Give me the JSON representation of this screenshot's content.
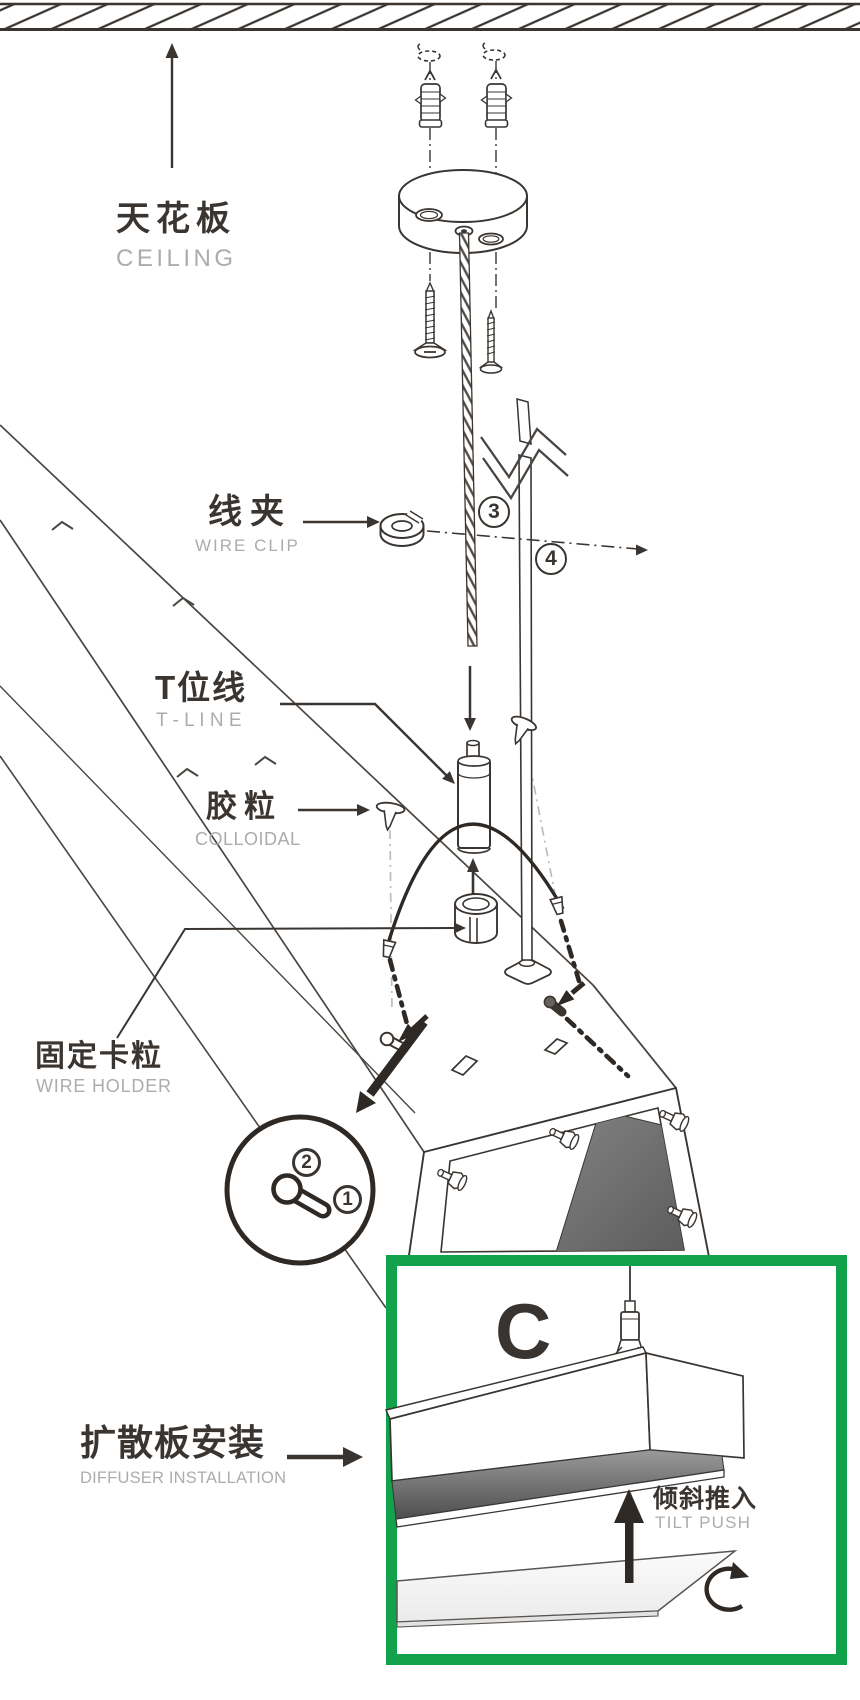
{
  "labels": {
    "ceiling": {
      "zh": "天花板",
      "en": "CEILING"
    },
    "wire_clip": {
      "zh": "线夹",
      "en": "WIRE CLIP"
    },
    "t_line": {
      "zh": "T位线",
      "en": "T - L I N E"
    },
    "colloidal": {
      "zh": "胶粒",
      "en": "COLLOIDAL"
    },
    "wire_holder": {
      "zh": "固定卡粒",
      "en": "WIRE HOLDER"
    },
    "diffuser": {
      "zh": "扩散板安装",
      "en": "DIFFUSER INSTALLATION"
    },
    "tilt_push": {
      "zh": "倾斜推入",
      "en": "TILT PUSH"
    }
  },
  "steps": {
    "wire_rope": "3",
    "straight_wire": "4",
    "detail_lock": "2",
    "detail_slot": "1"
  },
  "detail_view": {
    "panel_label": "C"
  },
  "colors": {
    "line": "#3A3531",
    "muted_text": "#ACACAC",
    "accent_green": "#11A24B",
    "panel_gray": "#5F5F5F"
  }
}
